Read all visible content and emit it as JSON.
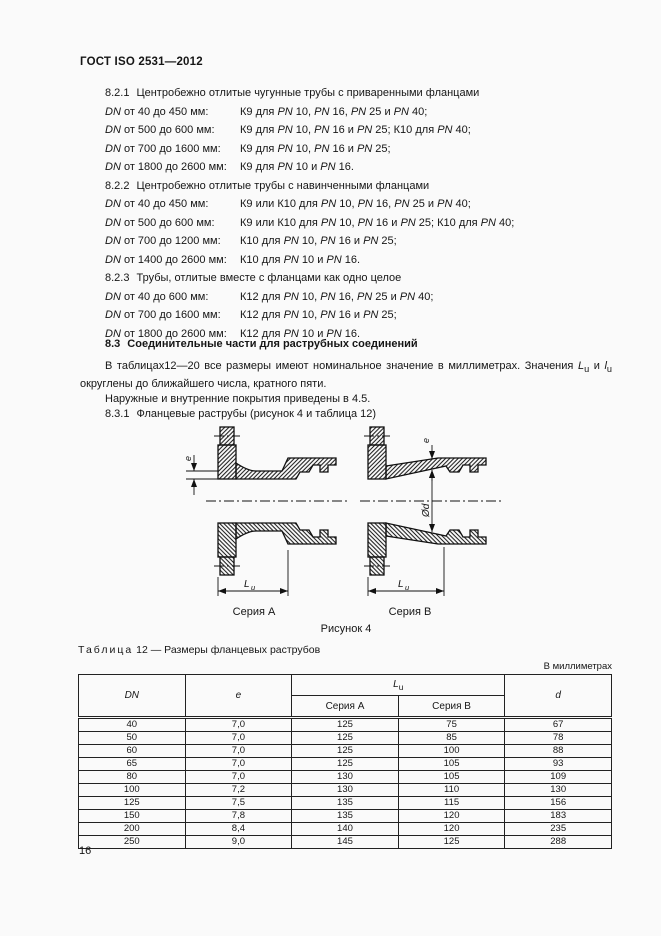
{
  "page": {
    "header": "ГОСТ ISO 2531—2012",
    "number": "16"
  },
  "sections": [
    {
      "num": "8.2.1",
      "title": "Центробежно отлитые чугунные трубы с приваренными фланцами",
      "items": [
        {
          "label": "*DN* от 40 до 450 мм:",
          "spec": "К9 для *PN* 10, *PN* 16, *PN* 25 и *PN* 40;"
        },
        {
          "label": "*DN* от 500 до 600 мм:",
          "spec": "К9 для *PN* 10, *PN* 16 и *PN* 25; К10 для *PN* 40;"
        },
        {
          "label": "*DN* от 700 до 1600 мм:",
          "spec": "К9 для *PN* 10, *PN* 16 и *PN* 25;"
        },
        {
          "label": "*DN* от 1800 до 2600 мм:",
          "spec": "К9 для *PN* 10 и *PN* 16."
        }
      ]
    },
    {
      "num": "8.2.2",
      "title": "Центробежно отлитые трубы с навинченными фланцами",
      "items": [
        {
          "label": "*DN* от 40 до 450 мм:",
          "spec": "К9 или К10 для *PN* 10, *PN* 16, *PN* 25 и *PN* 40;"
        },
        {
          "label": "*DN* от 500 до 600 мм:",
          "spec": "К9 или К10 для *PN* 10, *PN* 16 и *PN* 25; К10 для *PN* 40;"
        },
        {
          "label": "*DN* от 700 до 1200 мм:",
          "spec": "К10 для *PN* 10, *PN* 16 и *PN* 25;"
        },
        {
          "label": "*DN* от 1400 до 2600 мм:",
          "spec": "К10 для *PN* 10 и *PN* 16."
        }
      ]
    },
    {
      "num": "8.2.3",
      "title": "Трубы, отлитые вместе с фланцами как одно целое",
      "items": [
        {
          "label": "*DN* от 40 до 600 мм:",
          "spec": "К12 для *PN* 10, *PN* 16, *PN* 25 и *PN* 40;"
        },
        {
          "label": "*DN* от 700 до 1600 мм:",
          "spec": "К12 для *PN* 10, *PN* 16 и *PN* 25;"
        },
        {
          "label": "*DN* от 1800 до 2600 мм:",
          "spec": "К12 для *PN* 10 и *PN* 16."
        }
      ]
    }
  ],
  "section83": {
    "num": "8.3",
    "title": "Соединительные части для раструбных соединений",
    "para1": "В таблицах12—20 все размеры имеют номинальное значение в миллиметрах. Значения *L*~u~ и *l*~u~ округлены до ближайшего числа, кратного пяти.",
    "para2": "Наружные и внутренние покрытия приведены в 4.5.",
    "sub_num": "8.3.1",
    "sub_title": "Фланцевые раструбы (рисунок 4 и таблица 12)"
  },
  "figure": {
    "series_a": "Серия А",
    "series_b": "Серия В",
    "caption": "Рисунок 4",
    "dim_e": "e",
    "dim_l": "L",
    "dim_l_sub": "u",
    "dim_d": "Ød"
  },
  "table": {
    "caption_word": "Таблица",
    "caption_rest": "12 — Размеры фланцевых раструбов",
    "units_note": "В миллиметрах",
    "headers": {
      "dn": "*DN*",
      "e": "*e*",
      "lu": "*L*~u~",
      "series_a": "Серия A",
      "series_b": "Серия B",
      "d": "*d*"
    },
    "rows": [
      [
        "40",
        "7,0",
        "125",
        "75",
        "67"
      ],
      [
        "50",
        "7,0",
        "125",
        "85",
        "78"
      ],
      [
        "60",
        "7,0",
        "125",
        "100",
        "88"
      ],
      [
        "65",
        "7,0",
        "125",
        "105",
        "93"
      ],
      [
        "80",
        "7,0",
        "130",
        "105",
        "109"
      ],
      [
        "100",
        "7,2",
        "130",
        "110",
        "130"
      ],
      [
        "125",
        "7,5",
        "135",
        "115",
        "156"
      ],
      [
        "150",
        "7,8",
        "135",
        "120",
        "183"
      ],
      [
        "200",
        "8,4",
        "140",
        "120",
        "235"
      ],
      [
        "250",
        "9,0",
        "145",
        "125",
        "288"
      ]
    ]
  }
}
